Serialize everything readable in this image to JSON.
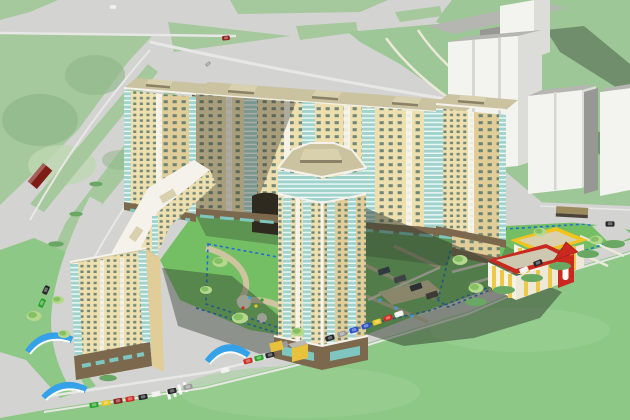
{
  "scene": {
    "kind": "3d-architectural-aerial-rendering",
    "subject": "residential-complex-with-courtyard-kindergarten-and-street-network",
    "view": "isometric-birds-eye",
    "text_content": "none"
  },
  "palette": {
    "road": "#d3d3d1",
    "road_light": "#e7e7e5",
    "lawn_soft": "#a6c89d",
    "lawn_soft_dark": "#8db687",
    "lawn_soft_light": "#bdd8b2",
    "grass_bright": "#8ec887",
    "grass_yard": "#74bf64",
    "grass_topright": "#9dc796",
    "path_tan": "#cec4a0",
    "path_light": "#ece9db",
    "facade_lit": "#eedfae",
    "facade_mid": "#e0cd98",
    "window_dark": "#50706a",
    "glazing_teal": "#9fd3cc",
    "pier_white": "#f7f5ed",
    "roof_tan": "#cbc2a0",
    "roof_penthouse": "#d9d0ae",
    "roof_side_dark": "#8a8166",
    "parapet_white": "#f4f2ea",
    "base_brown": "#7c684d",
    "storefront_teal": "#7fc6c0",
    "white_front": "#f3f3f0",
    "white_side": "#dcdcd9",
    "white_roof": "#b5b5b2",
    "white_dark": "#979794",
    "shadow_green": "#2f3a2e",
    "boundary_blue": "#1e6fd2",
    "canopy_blue": "#35a1e8",
    "kinder_red": "#c9291f",
    "kinder_yellow": "#f2c31c",
    "kinder_wall": "#f7f3e2",
    "kinder_window": "#ecc94b",
    "tree_light": "#b4d88d",
    "tree_dark": "#7dbd5b",
    "bush_dark": "#69a862",
    "sand": "#e2d3a8",
    "arch_dark": "#2e2a20",
    "kiosk_yellow": "#e8c23c",
    "kiosk_gray": "#b9b9b2",
    "car_red": "#cf2b20",
    "car_darkred": "#8e1f1a",
    "car_blue": "#2d50c8",
    "car_yellow": "#e9c522",
    "car_green": "#2ba32b",
    "car_black": "#26262a",
    "car_white": "#f0f0ee",
    "car_gray": "#9a9a9a",
    "bus_darkred": "#7e1c16",
    "bus_tan": "#9a8a5e",
    "bus_dark": "#4a4438"
  },
  "inventory": {
    "buildings": [
      "main-north-slab",
      "tower-northwest",
      "tower-northeast",
      "east-wing-stub",
      "west-slab",
      "tower-southwest",
      "central-tower",
      "white-context-building-1",
      "white-context-building-2",
      "white-context-building-3",
      "kindergarten-building"
    ],
    "site_elements": [
      "top-road",
      "diagonal-avenue",
      "bottom-street",
      "east-road",
      "northwest-lawn",
      "northeast-grass-field",
      "foreground-lawn",
      "courtyard-green",
      "front-yard",
      "kindergarten-plot",
      "blue-dashed-parcel-boundaries",
      "winding-paths",
      "sand-playground",
      "bus-stop-canopies",
      "kiosk",
      "crosswalk",
      "cast-shadows",
      "cars",
      "buses",
      "truck",
      "trees",
      "bushes",
      "playground-equipment"
    ]
  }
}
